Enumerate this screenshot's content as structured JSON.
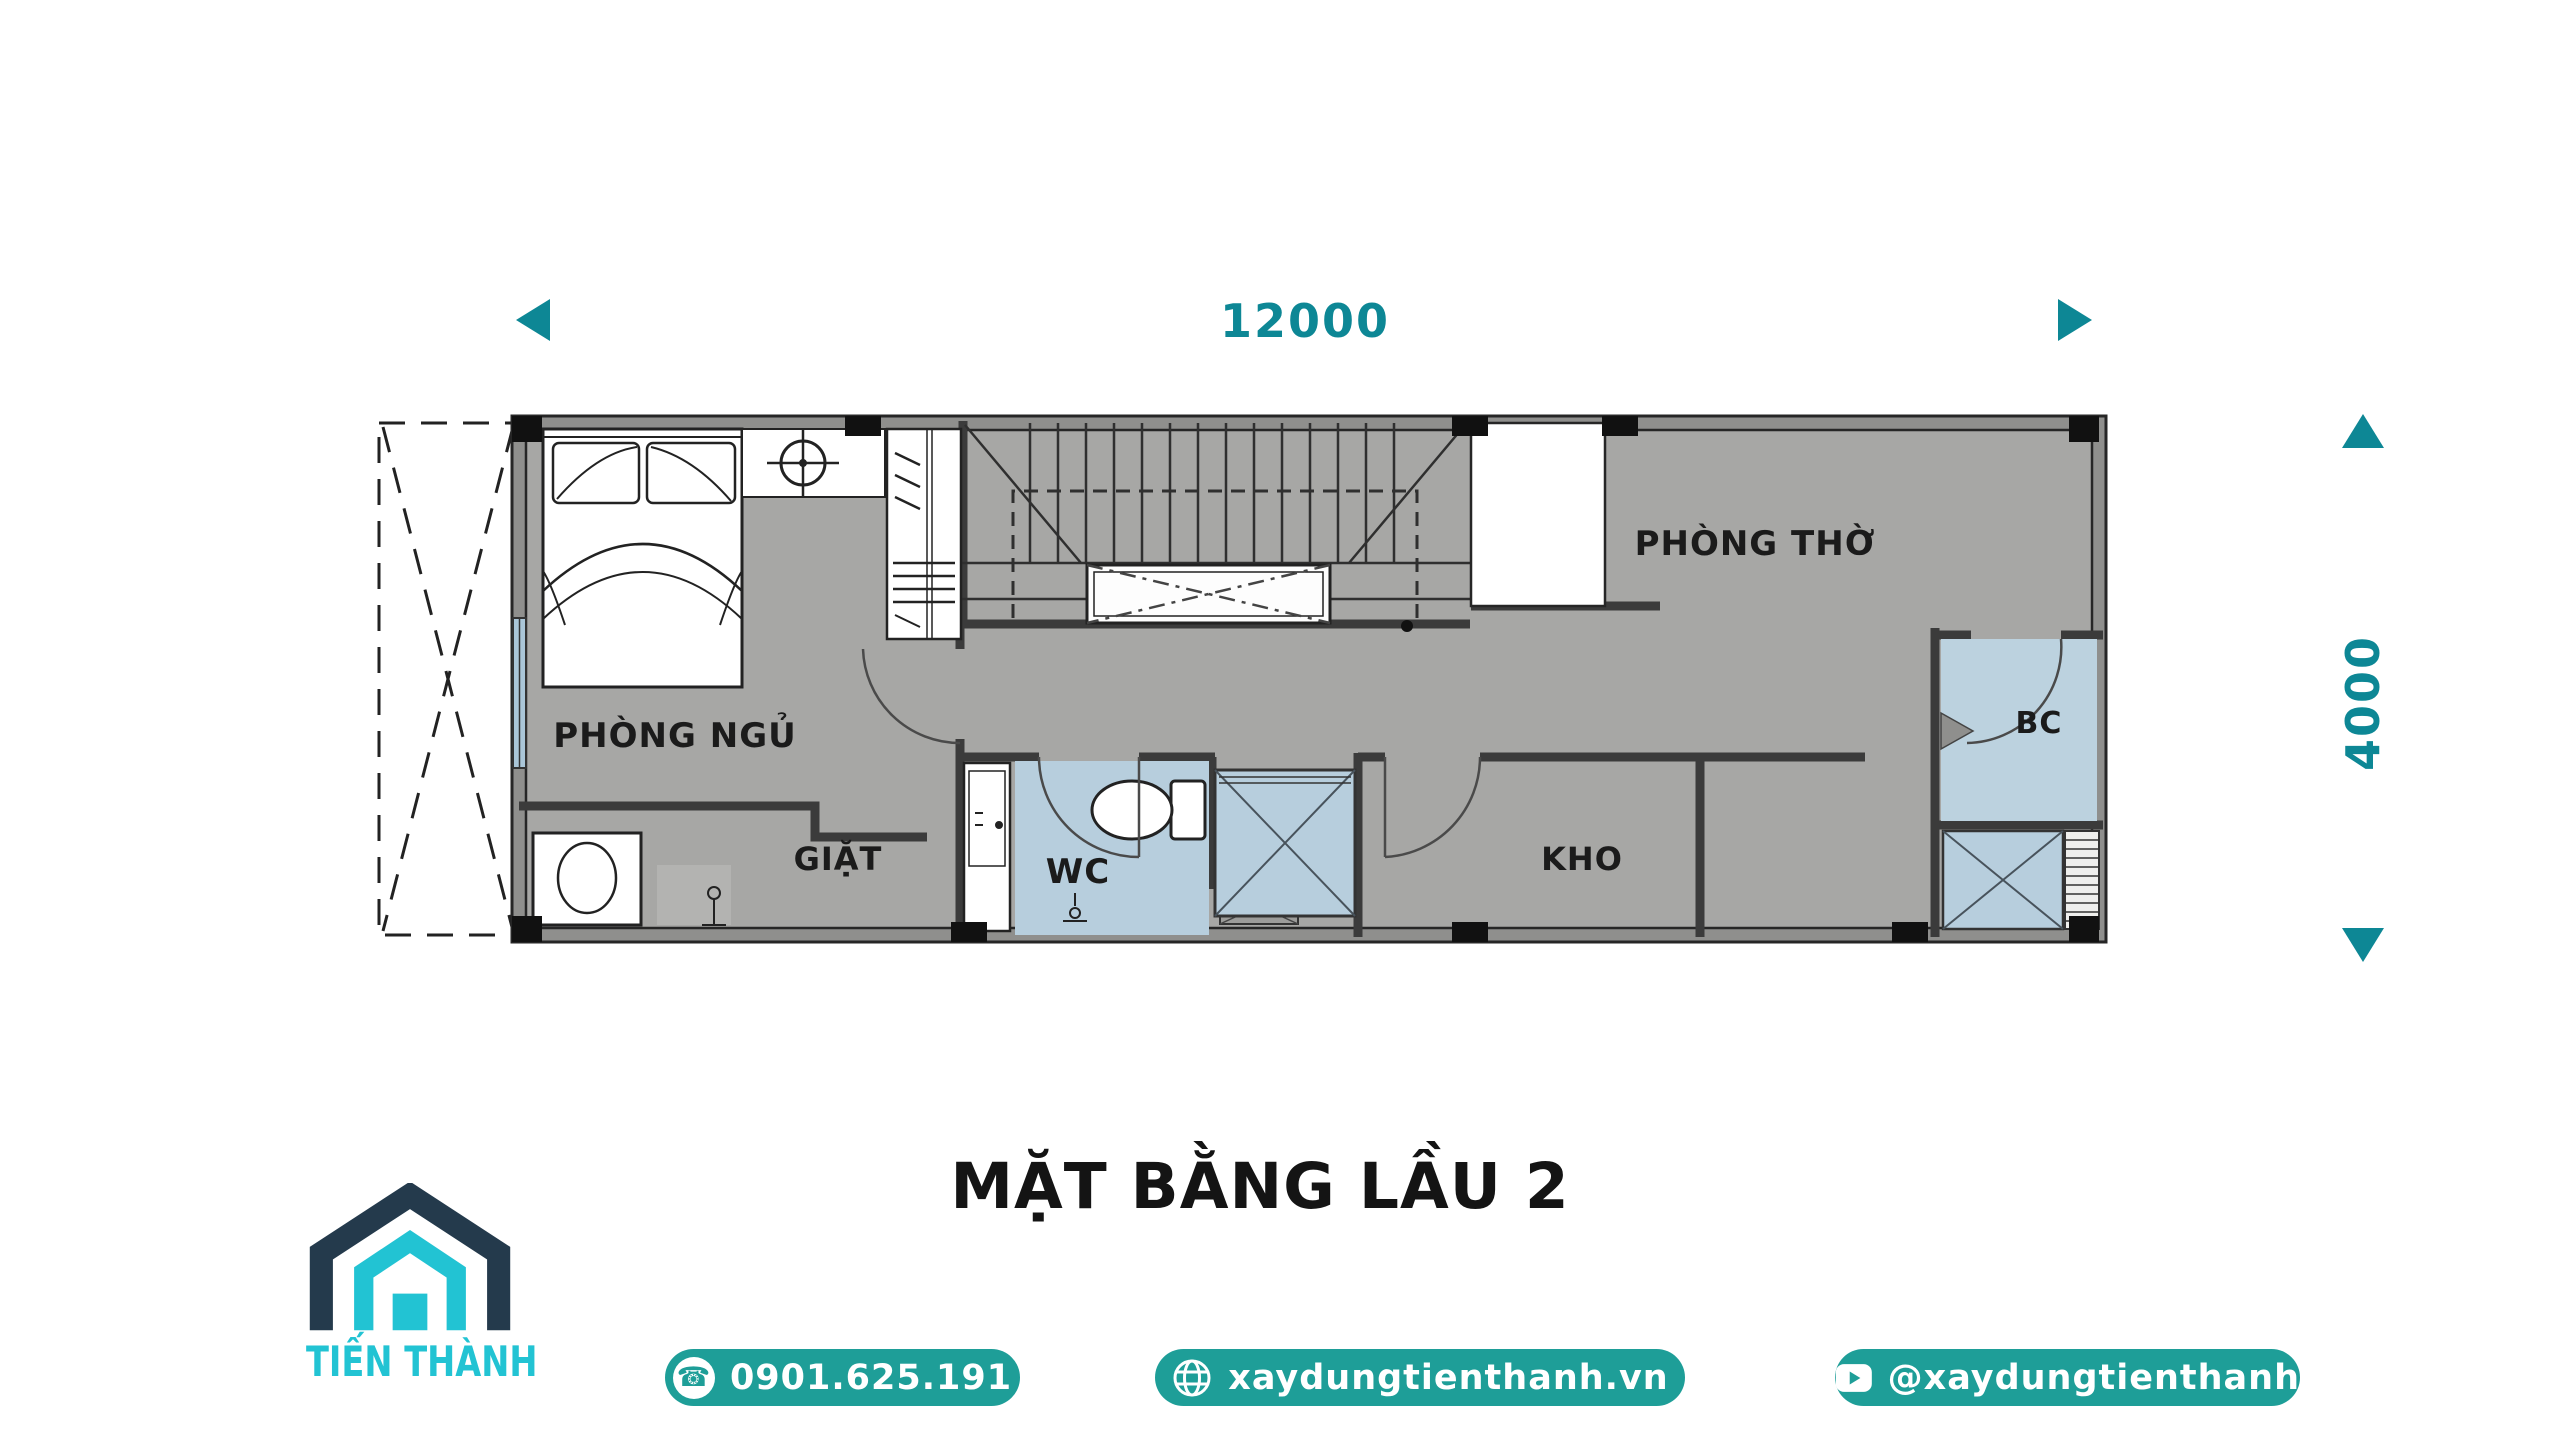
{
  "colors": {
    "tealDim": "#0d8795",
    "tealBtn": "#1e9e98",
    "logoCyan": "#22c3d3",
    "logoNavy": "#243a4c",
    "planFloor": "#a7a7a5",
    "planWallBand": "#8f8f8d",
    "planWallLine": "#2a2a2a",
    "wetBlue": "#b7cedd",
    "winBlue": "#aac6d8",
    "ink": "#1b1b1b"
  },
  "dimensions": {
    "horizontal": {
      "label": "12000"
    },
    "vertical": {
      "label": "4000"
    }
  },
  "floor_plan": {
    "rooms": [
      {
        "id": "phong-ngu",
        "label": "PHÒNG NGỦ"
      },
      {
        "id": "giat",
        "label": "GIẶT"
      },
      {
        "id": "wc",
        "label": "WC"
      },
      {
        "id": "kho",
        "label": "KHO"
      },
      {
        "id": "phong-tho",
        "label": "PHÒNG THỜ"
      },
      {
        "id": "bc",
        "label": "BC"
      }
    ]
  },
  "title": {
    "text": "MẶT BẰNG LẦU 2"
  },
  "brand": {
    "name": "TIẾN THÀNH"
  },
  "contact": {
    "phone": {
      "label": "0901.625.191",
      "icon": "phone-icon"
    },
    "website": {
      "label": "xaydungtienthanh.vn",
      "icon": "globe-icon"
    },
    "youtube": {
      "label": "@xaydungtienthanh",
      "icon": "youtube-play-icon"
    }
  }
}
